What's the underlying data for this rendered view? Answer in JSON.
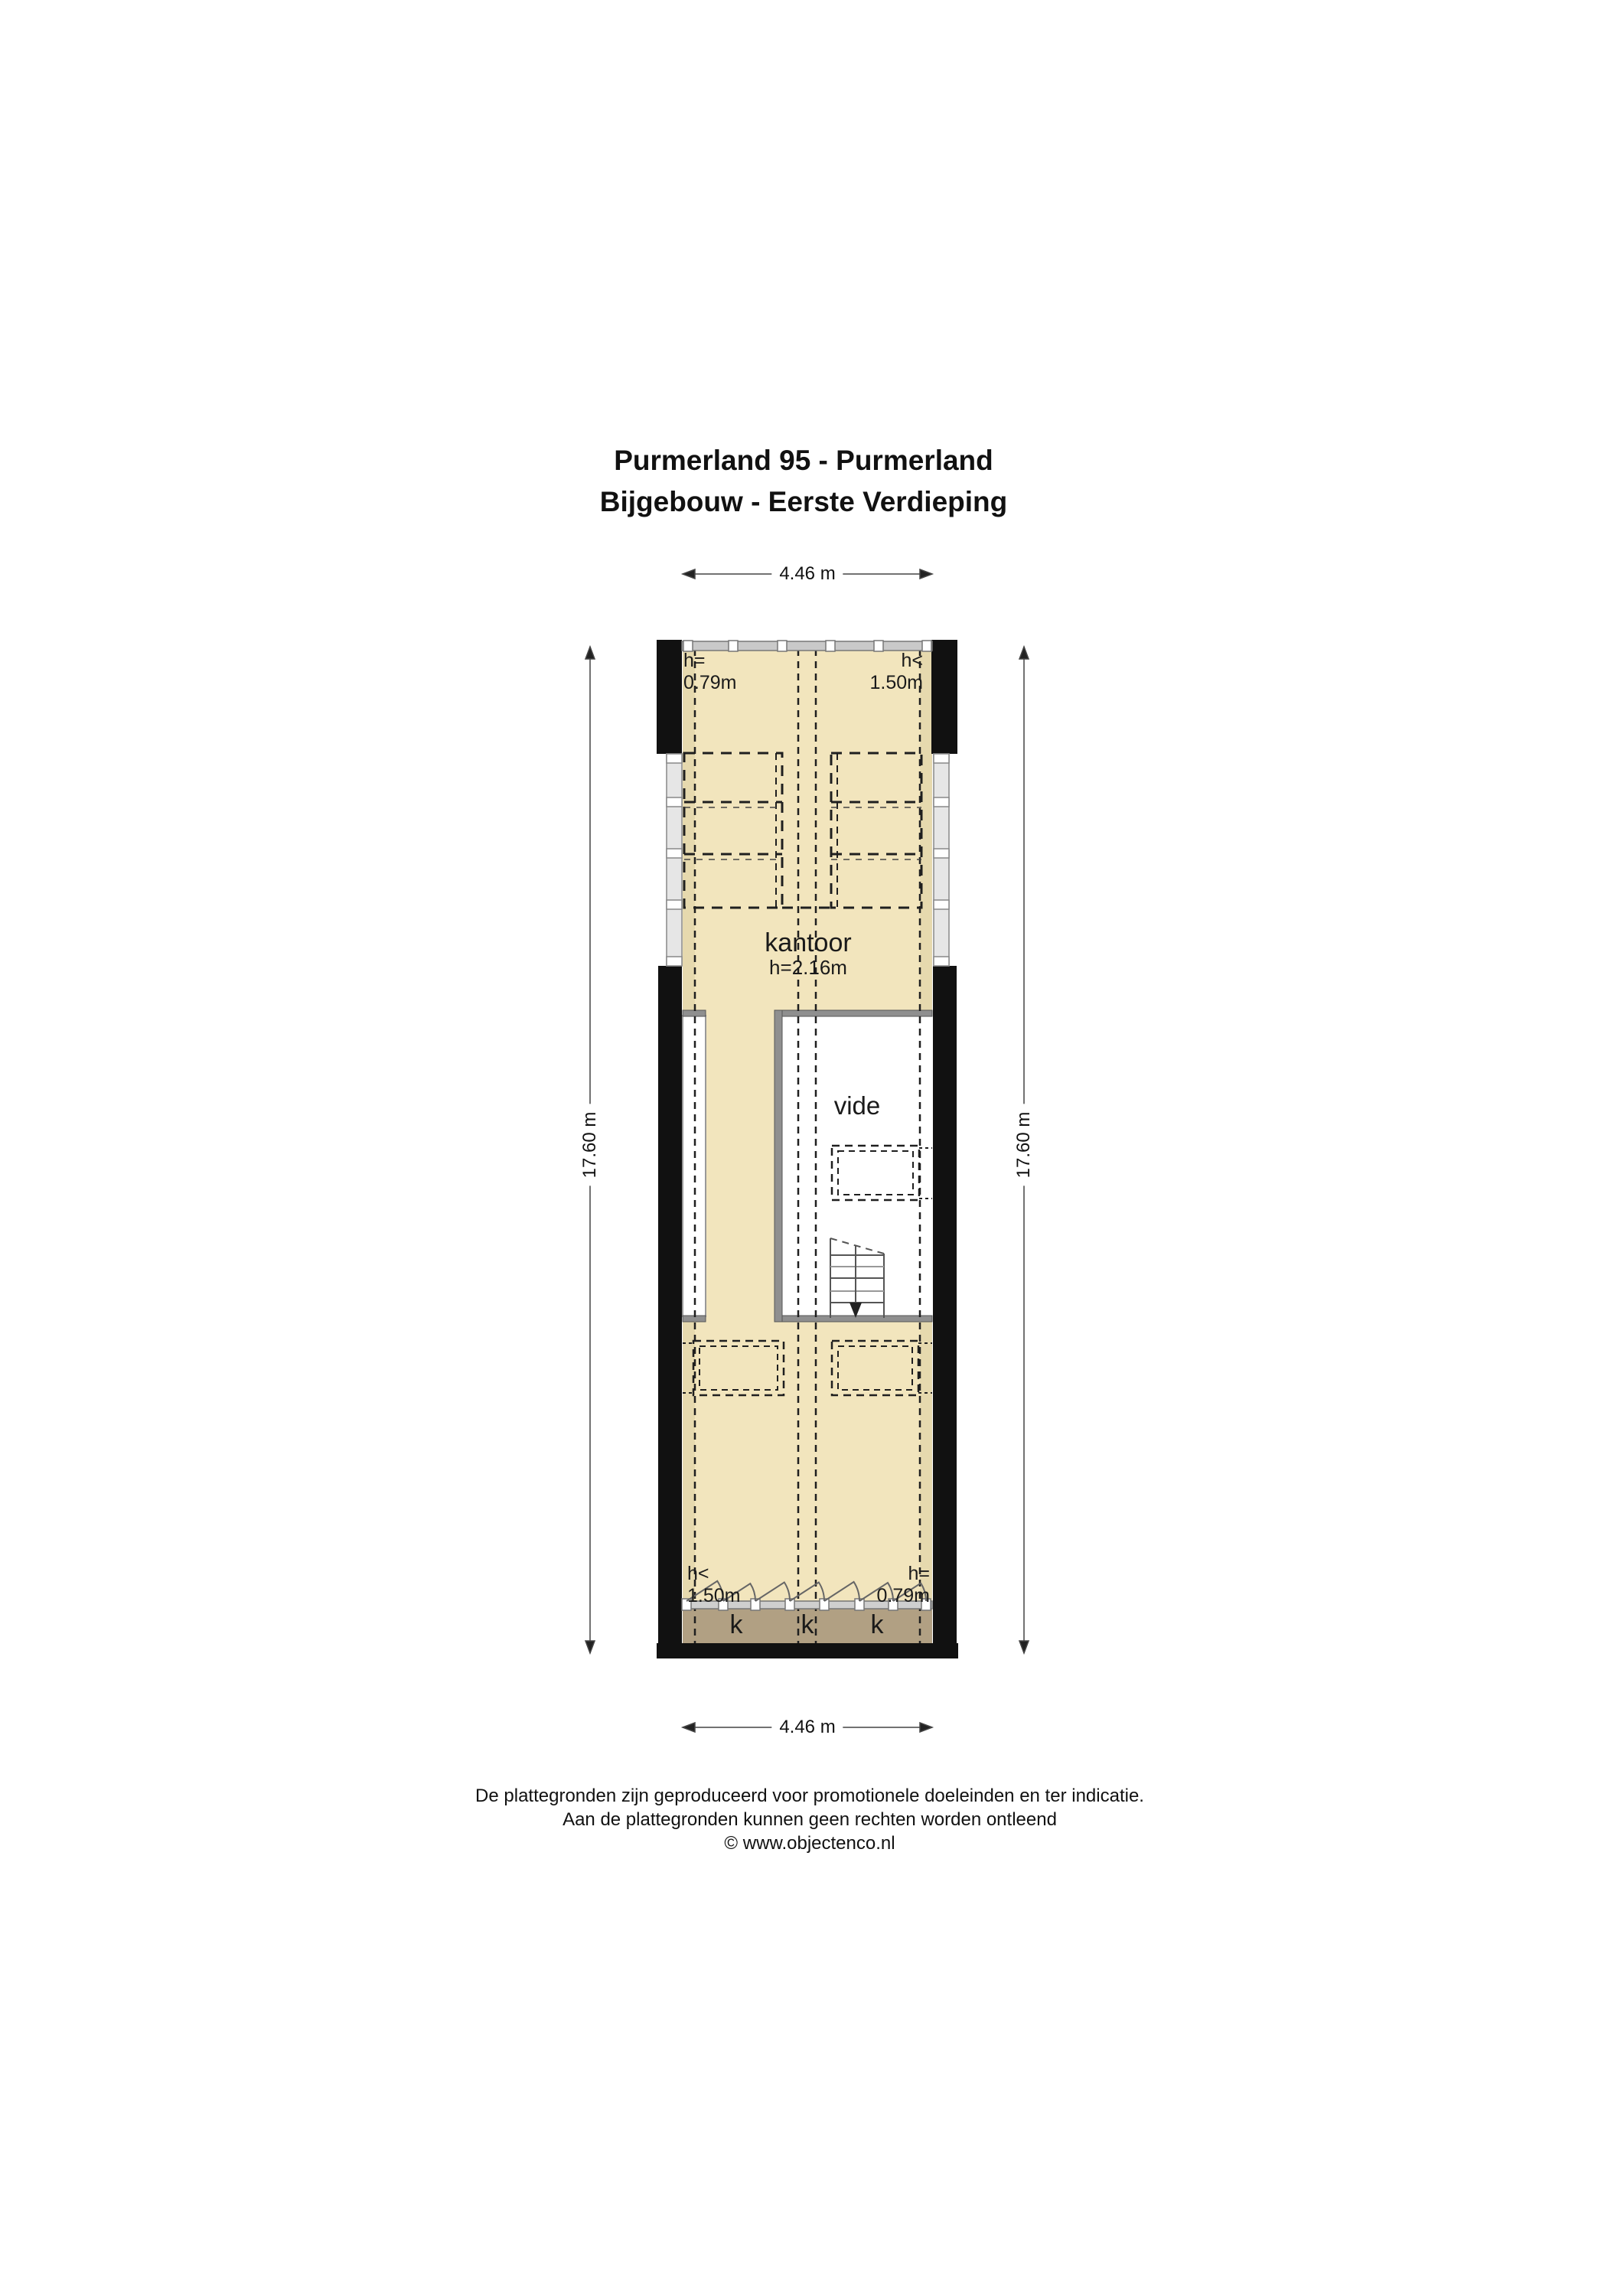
{
  "title": {
    "line1": "Purmerland 95 - Purmerland",
    "line2": "Bijgebouw - Eerste Verdieping"
  },
  "dimensions": {
    "width_top": "4.46 m",
    "width_bottom": "4.46 m",
    "length_left": "17.60 m",
    "length_right": "17.60 m"
  },
  "rooms": {
    "kantoor": {
      "label": "kantoor",
      "ceiling_height": "h=2.16m"
    },
    "vide": {
      "label": "vide"
    }
  },
  "height_markers": {
    "top_left": {
      "symbol": "h=",
      "value": "0.79m"
    },
    "top_right": {
      "symbol": "h<",
      "value": "1.50m"
    },
    "bottom_left": {
      "symbol": "h<",
      "value": "1.50m"
    },
    "bottom_right": {
      "symbol": "h=",
      "value": "0.79m"
    }
  },
  "closets": {
    "labels": [
      "k",
      "k",
      "k"
    ]
  },
  "footer": {
    "line1": "De plattegronden zijn geproduceerd voor promotionele doeleinden en ter indicatie.",
    "line2": "Aan de plattegronden kunnen geen rechten worden ontleend",
    "line3": "© www.objectenco.nl"
  },
  "colors": {
    "floor": "#f2e5bd",
    "floor_shaded": "#e6d9ae",
    "closet_band": "#b1a083",
    "wall": "#111111",
    "interior_wall": "#8f8f8f",
    "window_band": "#c9c9c9"
  }
}
